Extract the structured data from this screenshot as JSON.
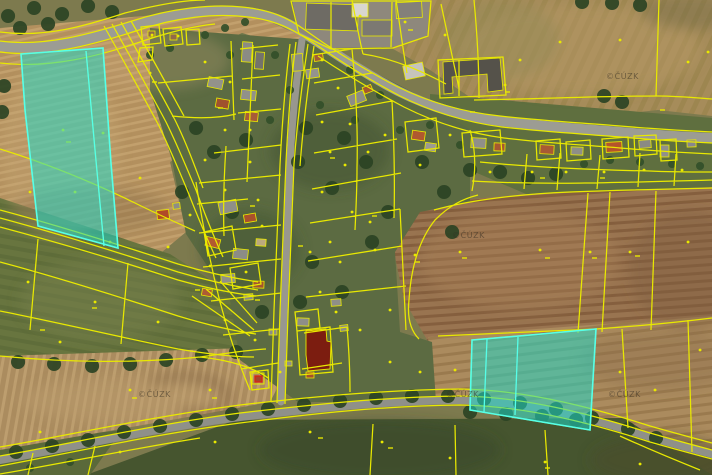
{
  "map": {
    "description": "aerial cadastral map with parcel boundaries",
    "watermark": {
      "text": "©ČÚZK",
      "instances": [
        {
          "x": 606,
          "y": 79
        },
        {
          "x": 452,
          "y": 238
        },
        {
          "x": 138,
          "y": 397
        },
        {
          "x": 446,
          "y": 397
        },
        {
          "x": 608,
          "y": 397
        }
      ]
    },
    "colors": {
      "parcel_line": "#e9e900",
      "highlight_fill": "#1bdccd",
      "highlight_stroke": "#55ffe9",
      "red_building_outline": "#e02010"
    },
    "highlight": {
      "fill_opacity": "0.52",
      "northwest": {
        "points": "21,54 103,48 111,163 118,248 38,226 25,110",
        "divider": "86,51 95,150 104,246"
      },
      "southeast": {
        "points": "472,340 530,335 596,329 590,430 470,410",
        "divider1": "487,339 484,412",
        "divider2": "518,337 515,415"
      }
    }
  }
}
